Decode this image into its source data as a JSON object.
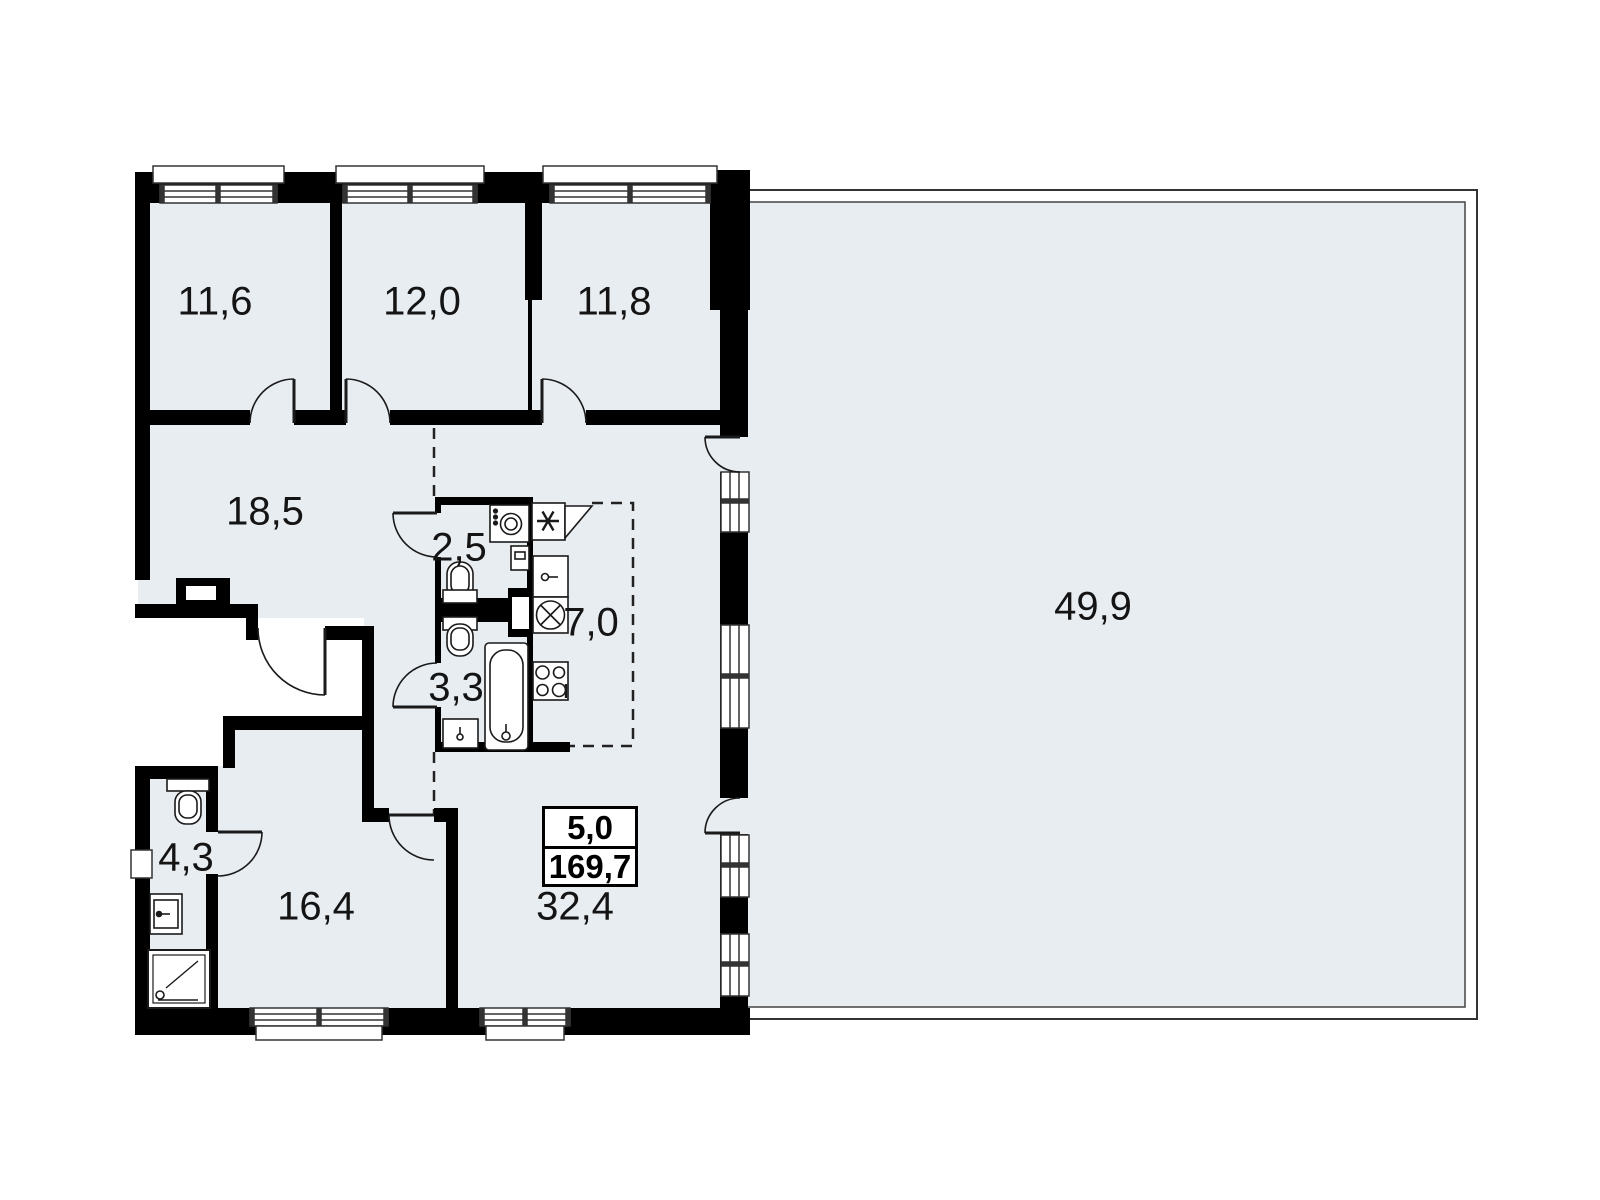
{
  "plan": {
    "title": "apartment-floor-plan",
    "colors": {
      "room_fill": "#e8edf2",
      "wall": "#000000",
      "background": "#ffffff",
      "line": "#333333"
    },
    "rooms": [
      {
        "name": "bedroom-1",
        "area": "11,6"
      },
      {
        "name": "bedroom-2",
        "area": "12,0"
      },
      {
        "name": "bedroom-3",
        "area": "11,8"
      },
      {
        "name": "hallway",
        "area": "18,5"
      },
      {
        "name": "wc",
        "area": "2,5"
      },
      {
        "name": "kitchen",
        "area": "7,0"
      },
      {
        "name": "bathroom",
        "area": "3,3"
      },
      {
        "name": "bathroom-2",
        "area": "4,3"
      },
      {
        "name": "bedroom-4",
        "area": "16,4"
      },
      {
        "name": "living-room",
        "area": "32,4"
      },
      {
        "name": "terrace",
        "area": "49,9"
      }
    ],
    "summary": {
      "terrace_reduced_area": "5,0",
      "total_area": "169,7"
    }
  }
}
